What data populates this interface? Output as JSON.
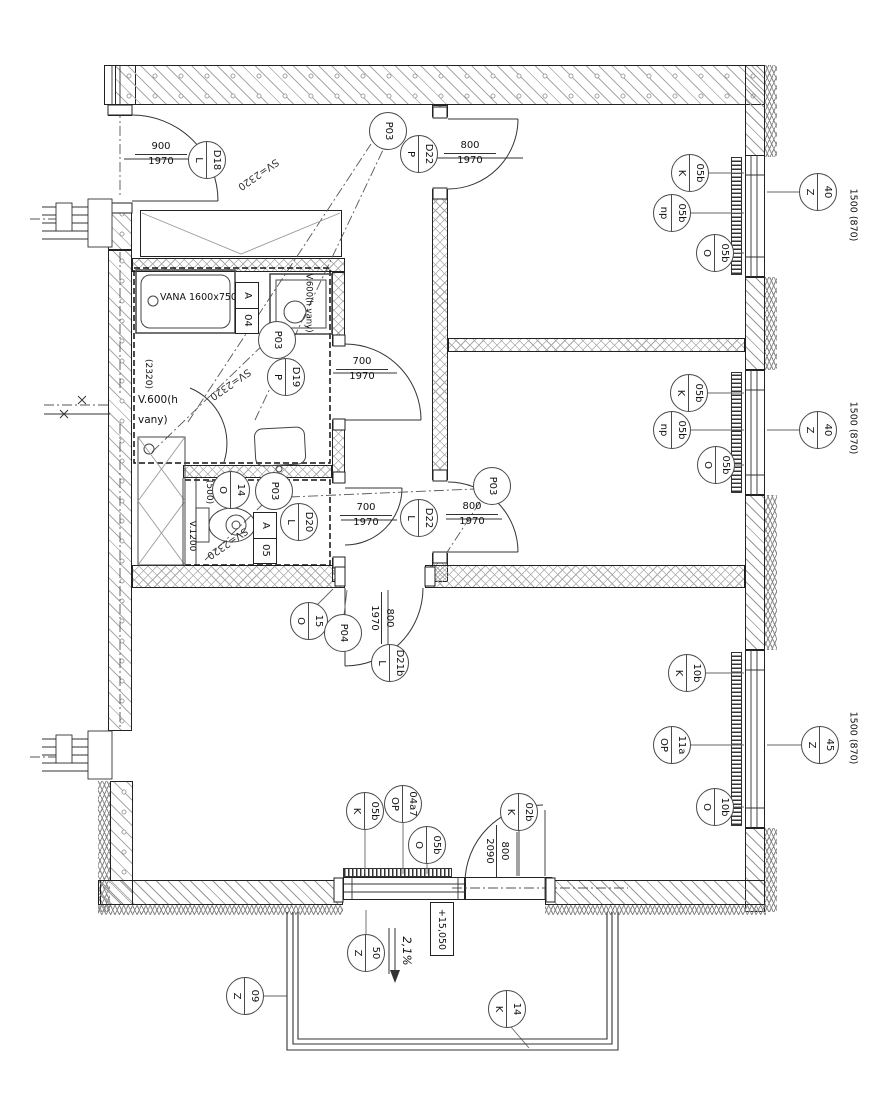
{
  "colors": {
    "line": "#2a2a2a",
    "hatch": "#9a9a9a",
    "paper": "#ffffff"
  },
  "markers": [
    {
      "n": "D18",
      "l": "L"
    },
    {
      "s": "P03"
    },
    {
      "n": "D22",
      "l": "P"
    },
    {
      "n": "05b",
      "l": "K"
    },
    {
      "n": "05b",
      "l": "np"
    },
    {
      "n": "05b",
      "l": "O"
    },
    {
      "n": "40",
      "l": "Z"
    },
    {
      "s": "P03"
    },
    {
      "n": "D19",
      "l": "P"
    },
    {
      "n": "05b",
      "l": "K"
    },
    {
      "n": "05b",
      "l": "np"
    },
    {
      "n": "05b",
      "l": "O"
    },
    {
      "n": "40",
      "l": "Z"
    },
    {
      "s": "P03"
    },
    {
      "n": "14",
      "l": "O"
    },
    {
      "n": "D20",
      "l": "L"
    },
    {
      "s": "P03"
    },
    {
      "n": "D22",
      "l": "L"
    },
    {
      "n": "15",
      "l": "O"
    },
    {
      "s": "P04"
    },
    {
      "n": "D21b",
      "l": "L"
    },
    {
      "n": "10b",
      "l": "K"
    },
    {
      "n": "11a",
      "l": "OP"
    },
    {
      "n": "10b",
      "l": "O"
    },
    {
      "n": "45",
      "l": "Z"
    },
    {
      "n": "05b",
      "l": "K"
    },
    {
      "n": "04a7",
      "l": "OP"
    },
    {
      "n": "05b",
      "l": "O"
    },
    {
      "n": "02b",
      "l": "K"
    },
    {
      "n": "50",
      "l": "Z"
    },
    {
      "n": "09",
      "l": "Z"
    },
    {
      "n": "14",
      "l": "K"
    }
  ],
  "dims": [
    {
      "over": "900",
      "under": "1970"
    },
    {
      "over": "800",
      "under": "1970"
    },
    {
      "over": "700",
      "under": "1970"
    },
    {
      "over": "700",
      "under": "1970"
    },
    {
      "over": "800",
      "under": "1970"
    },
    {
      "over": "800",
      "under": "1970"
    },
    {
      "over": "800",
      "under": "2090"
    }
  ],
  "boxes": [
    {
      "top": "A",
      "bottom": "04"
    },
    {
      "top": "A",
      "bottom": "05"
    }
  ],
  "labels": {
    "bathtub": "VANA  1600x750mm",
    "tub_height": "(2320)",
    "v600_line1": "V.600(h",
    "v600_line2": "vany)",
    "ceiling": "SV=2320",
    "shaft_500": "(500)",
    "v1200": "V.1200",
    "window_span": "1500 (870)",
    "elevation": "+15,050",
    "slope": "2,1%"
  }
}
